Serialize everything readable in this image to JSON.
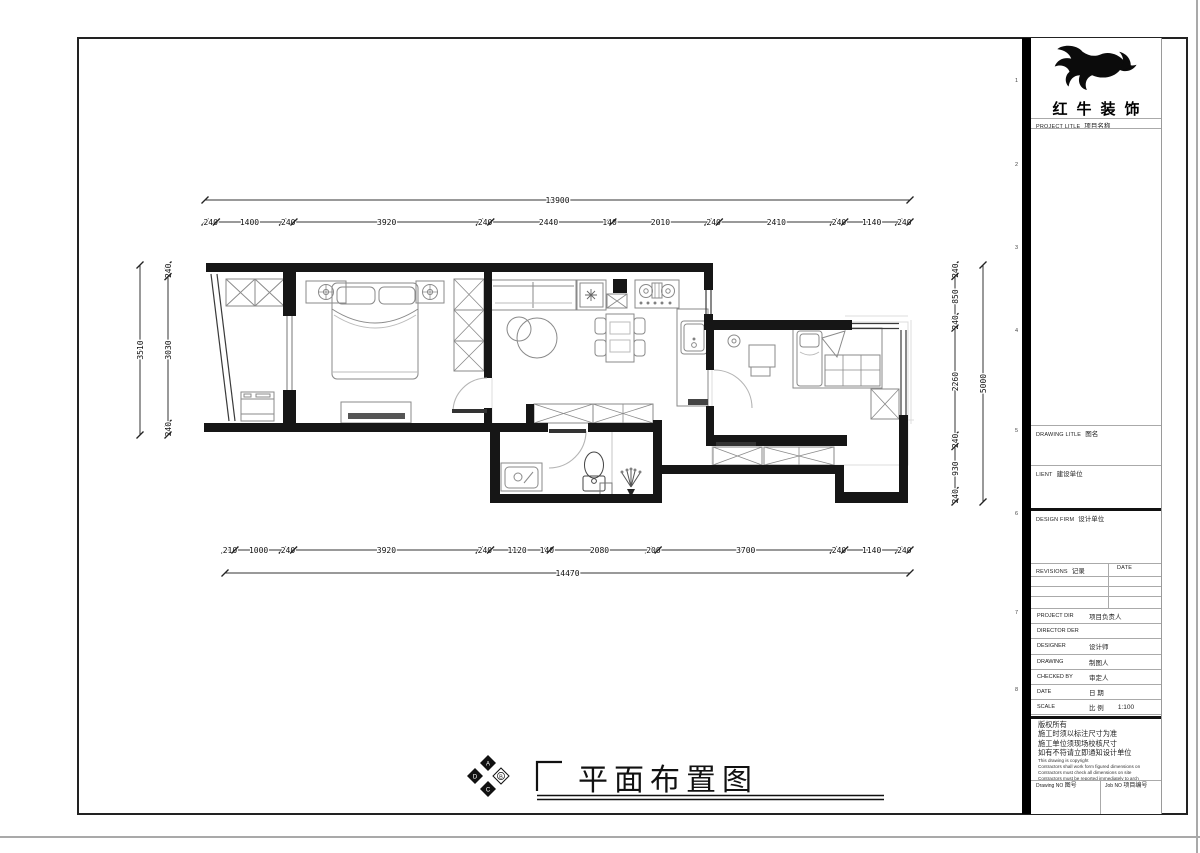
{
  "sheet": {
    "drawing_title": "平面布置图",
    "compass_letters": [
      "A",
      "B",
      "C",
      "D"
    ]
  },
  "dimensions": {
    "top": {
      "overall": "13900",
      "segments": [
        "240",
        "1400",
        "240",
        "3920",
        "240",
        "2440",
        "140",
        "2010",
        "240",
        "2410",
        "240",
        "1140",
        "240"
      ]
    },
    "bottom": {
      "overall": "14470",
      "segments": [
        "210",
        "1000",
        "240",
        "3920",
        "240",
        "1120",
        "140",
        "2080",
        "200",
        "3700",
        "240",
        "1140",
        "240"
      ]
    },
    "left": {
      "overall": "3510",
      "segments": [
        "240",
        "3030",
        "240"
      ]
    },
    "right": {
      "overall": "5000",
      "segments": [
        "240",
        "850",
        "240",
        "2260",
        "240",
        "930",
        "240"
      ]
    }
  },
  "grid_numbers": [
    "1",
    "2",
    "3",
    "4",
    "5",
    "6",
    "7",
    "8"
  ],
  "title_block": {
    "company": "红牛装饰",
    "project_row": {
      "en": "PROJECT LITLE",
      "cn": "项目名称"
    },
    "drawing_title_row": {
      "en": "DRAWING LITLE",
      "cn": "图名"
    },
    "client_row": {
      "en": "LIENT",
      "cn": "建设单位"
    },
    "design_firm_row": {
      "en": "DESIGN FIRM",
      "cn": "设计单位"
    },
    "revisions_header": {
      "en": "REVISIONS",
      "cn": "记录",
      "date": "DATE"
    },
    "staff_rows": [
      {
        "en": "PROJECT DIR",
        "cn": "项目负责人",
        "value": ""
      },
      {
        "en": "DIRECTOR DER",
        "cn": "",
        "value": ""
      },
      {
        "en": "DESIGNER",
        "cn": "设计师",
        "value": ""
      },
      {
        "en": "DRAWING",
        "cn": "制图人",
        "value": ""
      },
      {
        "en": "CHECKED BY",
        "cn": "审定人",
        "value": ""
      },
      {
        "en": "DATE",
        "cn": "日  期",
        "value": ""
      },
      {
        "en": "SCALE",
        "cn": "比  例",
        "value": "1:100"
      }
    ],
    "notes_cn": [
      "版权所有",
      "施工时须以标注尺寸为准",
      "施工单位须现场校核尺寸",
      "如有不符请立即通知设计单位"
    ],
    "notes_en": [
      "This drawing is copyright",
      "Contractors shall work form figured dimensions on",
      "Contractors must check all dimensions on site",
      "Contractors must be reported immediately to arch"
    ],
    "drawing_no_row": {
      "en": "Drawing NO",
      "cn": "图号"
    },
    "job_no_row": {
      "en": "Job NO",
      "cn": "项目编号"
    }
  },
  "colors": {
    "wall": "#161616",
    "furniture": "#8a8a8a",
    "dim_line": "#333333",
    "accent_black": "#000000"
  }
}
